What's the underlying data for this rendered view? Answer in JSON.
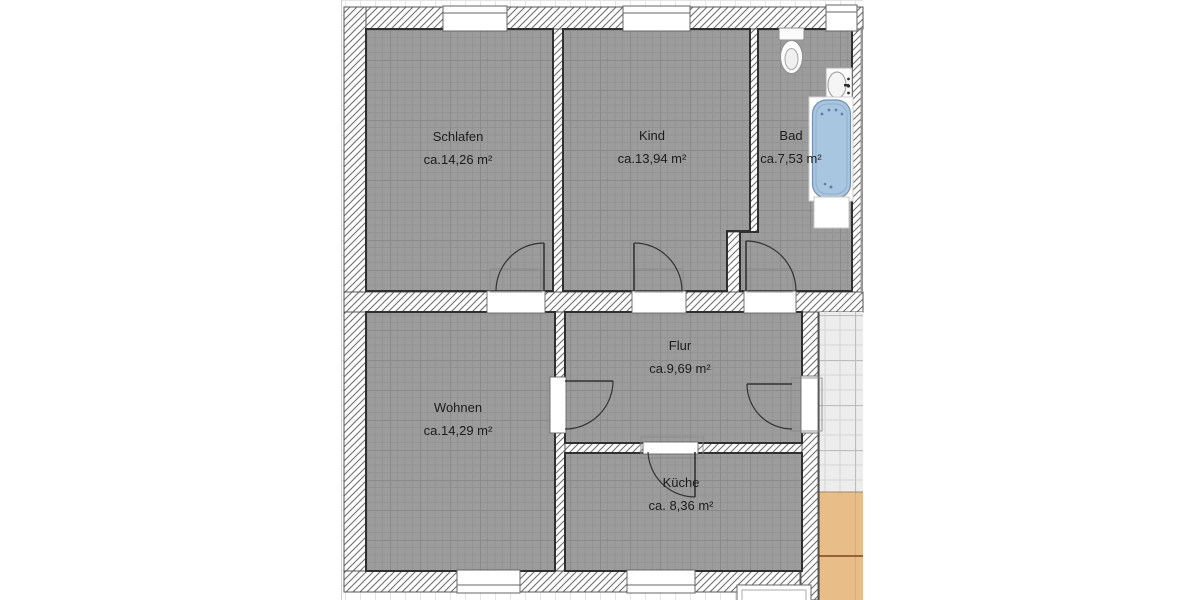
{
  "plan": {
    "title": "Wohnung Grundriss",
    "rooms": [
      {
        "id": "schlafen",
        "name": "Schlafen",
        "area": "ca.14,26 m²"
      },
      {
        "id": "kind",
        "name": "Kind",
        "area": "ca.13,94 m²"
      },
      {
        "id": "bad",
        "name": "Bad",
        "area": "ca.7,53 m²"
      },
      {
        "id": "flur",
        "name": "Flur",
        "area": "ca.9,69 m²"
      },
      {
        "id": "wohnen",
        "name": "Wohnen",
        "area": "ca.14,29 m²"
      },
      {
        "id": "kueche",
        "name": "Küche",
        "area": "ca. 8,36 m²"
      }
    ],
    "fixtures": [
      "toilet",
      "washbasin",
      "bathtub",
      "washing-machine"
    ],
    "colors": {
      "room_floor": "#9c9c9c",
      "wall_hatch_line": "#6e6e6e",
      "bathtub_fill": "#a9c6e1",
      "stair_tile": "#ededed",
      "wood_floor": "#e9bd87",
      "wood_joint_line": "#7a4426"
    }
  }
}
